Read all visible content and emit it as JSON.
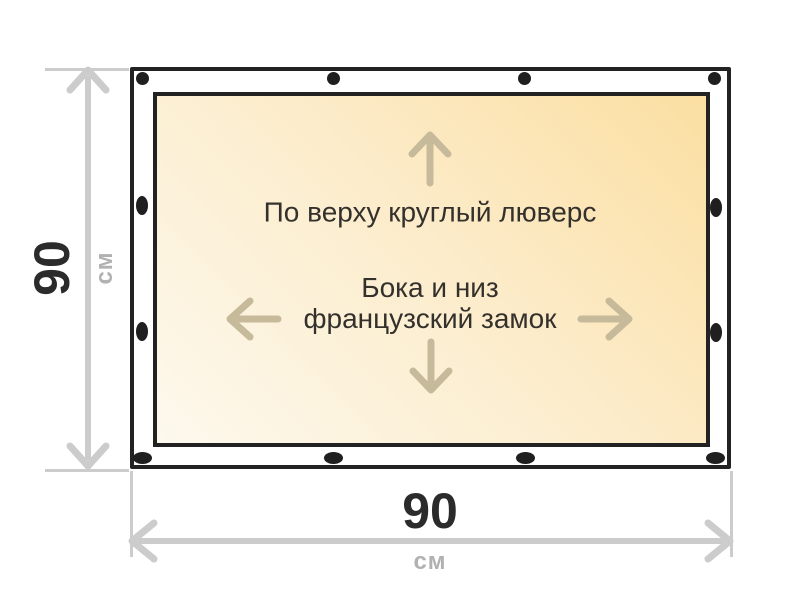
{
  "page": {
    "background": "#ffffff"
  },
  "tarp": {
    "border_color": "#222222",
    "fill_gradient": [
      "#fdf9ee",
      "#fceccb",
      "#fbdfa2"
    ],
    "grommet_color": "#1f1f1f",
    "arrow_color": "#c7ba9b",
    "annotations": {
      "top_edge": "По верху круглый люверс",
      "sides_line1": "Бока и низ",
      "sides_line2": "французский замок"
    }
  },
  "dimensions": {
    "line_color": "#cccccc",
    "height": {
      "value": "90",
      "unit": "см"
    },
    "width": {
      "value": "90",
      "unit": "см"
    }
  }
}
